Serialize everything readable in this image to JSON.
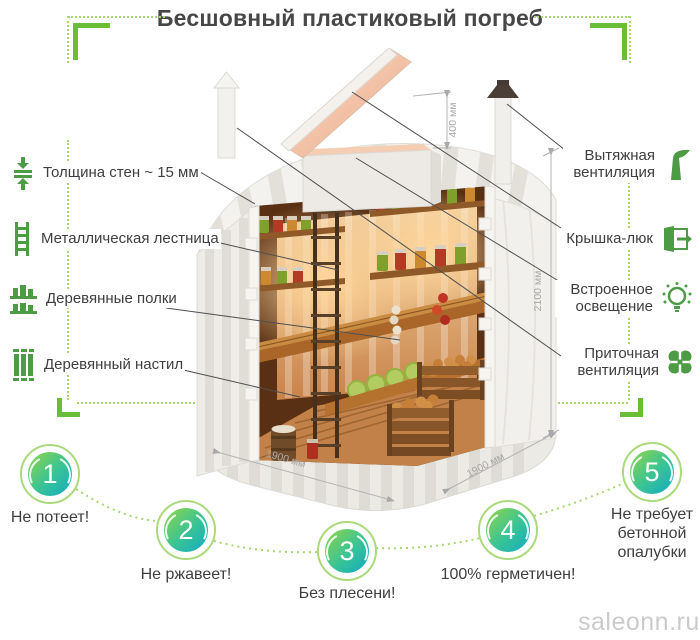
{
  "title": "Бесшовный пластиковый погреб",
  "features_left": [
    {
      "icon": "wall-thickness-icon",
      "label": "Толщина стен ~ 15 мм"
    },
    {
      "icon": "ladder-icon",
      "label": "Металлическая лестница"
    },
    {
      "icon": "shelves-icon",
      "label": "Деревянные полки"
    },
    {
      "icon": "planks-icon",
      "label": "Деревянный настил"
    }
  ],
  "features_right": [
    {
      "icon": "exhaust-vent-icon",
      "label": "Вытяжная вентиляция"
    },
    {
      "icon": "hatch-icon",
      "label": "Крышка-люк"
    },
    {
      "icon": "lighting-icon",
      "label": "Встроенное освещение"
    },
    {
      "icon": "supply-vent-icon",
      "label": "Приточная вентиляция"
    }
  ],
  "dimensions": {
    "hatch_neck": "400 мм",
    "height": "2100 мм",
    "width": "1900 мм",
    "depth": "1900 мм"
  },
  "benefits": [
    {
      "number": "1",
      "label": "Не потеет!"
    },
    {
      "number": "2",
      "label": "Не ржавеет!"
    },
    {
      "number": "3",
      "label": "Без плесени!"
    },
    {
      "number": "4",
      "label": "100% герметичен!"
    },
    {
      "number": "5",
      "label": "Не требует бетонной опалубки"
    }
  ],
  "watermark": "saleonn.ru",
  "colors": {
    "accent_green": "#4e9b46",
    "bracket_green": "#69be33",
    "dotted_green": "#a6d76d",
    "ring_green": "#abd97c",
    "circle_gradient_start": "#8ad44e",
    "circle_gradient_end": "#16adbd",
    "text": "#3e3e3e",
    "dimension_gray": "#a8a8a8",
    "watermark_gray": "#cbcbcb"
  }
}
